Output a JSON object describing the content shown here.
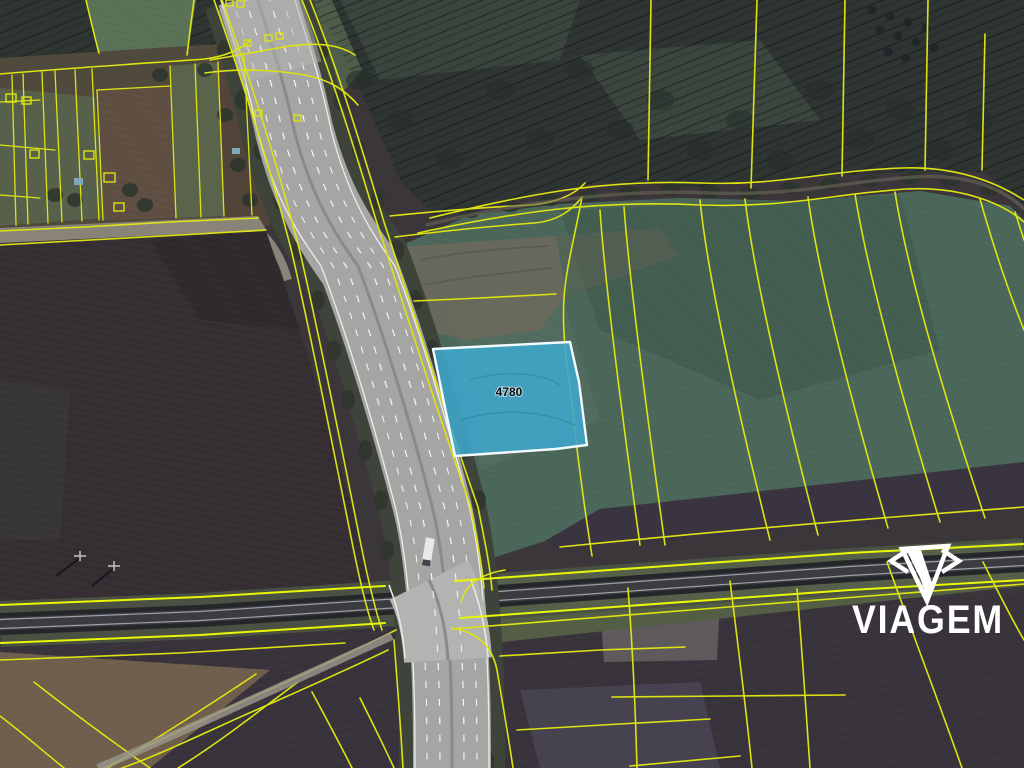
{
  "map": {
    "highlighted_parcel": {
      "number": "4780"
    },
    "watermark": {
      "brand": "VIAGEM"
    }
  },
  "colors": {
    "line-yellow": "#dde312",
    "line-yellow-bright": "#e9f707",
    "parcel-fill": "#3fa5c9",
    "parcel-border": "#f2fbff",
    "parcel-label": "#0d0d0d",
    "watermark": "#ffffff"
  }
}
